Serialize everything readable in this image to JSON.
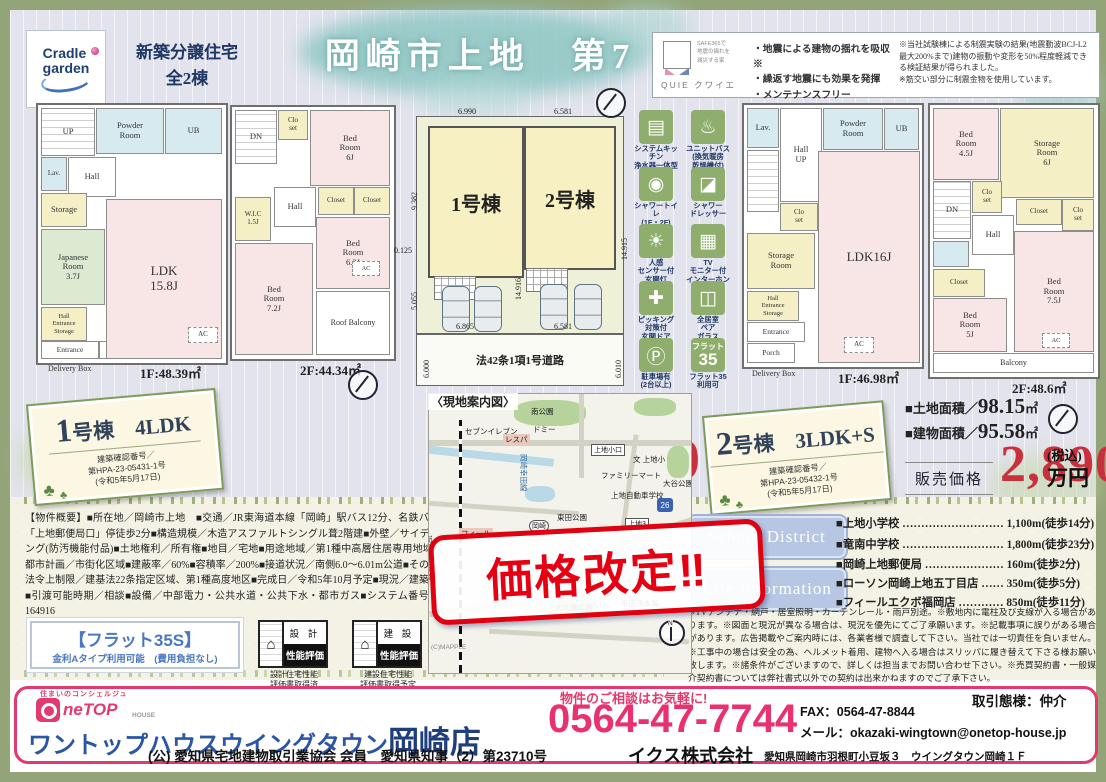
{
  "header": {
    "brand_line1": "Cradle",
    "brand_line2": "garden",
    "subtitle": "新築分譲住宅\n全2棟",
    "title": "岡崎市上地　第7",
    "quie": {
      "safe_text": "SAFE365で\n地震の揺れを\n減災する家",
      "brand": "QUIE クワイエ",
      "features": "・地震による建物の揺れを吸収※\n・繰返す地震にも効果を発揮\n・メンテナンスフリー",
      "note": "※当社試験棟による制震実験の結果(地震動波BCJ-L2最大200%まで)建物の振動や変形を50%程度軽減できる検証結果が得られました。\n※筋交い部分に制震金物を使用しています。"
    }
  },
  "plans": {
    "a1": {
      "rooms": [
        "UP",
        "Powder\nRoom",
        "UB",
        "Lav.",
        "Hall",
        "Storage",
        "Japanese\nRoom\n3.7J",
        "Hall\nEntrance\nStorage",
        "Entrance",
        "Porch",
        "LDK\n15.8J",
        "AC"
      ],
      "delivery": "Delivery Box",
      "area": "1F:48.39㎡"
    },
    "a2": {
      "rooms": [
        "DN",
        "Clo\nset",
        "Bed\nRoom\n6J",
        "W.I.C\n1.5J",
        "Hall",
        "Closet",
        "Closet",
        "Bed\nRoom\n6.3J",
        "Bed\nRoom\n7.2J",
        "Roof Balcony",
        "AC"
      ],
      "area": "2F:44.34㎡"
    },
    "b1": {
      "rooms": [
        "Lav.",
        "Hall\nUP",
        "Powder\nRoom",
        "UB",
        "Clo\nset",
        "Storage\nRoom",
        "Hall\nEntrance\nStorage",
        "Entrance",
        "Porch",
        "LDK16J",
        "AC"
      ],
      "delivery": "Delivery Box",
      "area": "1F:46.98㎡"
    },
    "b2": {
      "rooms": [
        "Bed\nRoom\n4.5J",
        "Storage\nRoom\n6J",
        "DN",
        "Clo\nset",
        "Hall",
        "Closet",
        "Clo\nset",
        "Closet",
        "Bed\nRoom\n5J",
        "Bed\nRoom\n7.5J",
        "Balcony",
        "AC"
      ],
      "area": "2F:48.6㎡"
    }
  },
  "siteplan": {
    "unit1": "1号棟",
    "unit2": "2号棟",
    "road": "法42条1項1号道路",
    "dims": {
      "top1": "6.990",
      "top2": "6.581",
      "left1": "9.382",
      "left2": "0.125",
      "left3": "5.055",
      "mid": "14.916",
      "right1": "14.915",
      "bottom1": "6.865",
      "bottom2": "6.581",
      "road_left": "6.000",
      "road_right": "6.010"
    }
  },
  "features_icons": {
    "items": [
      {
        "glyph": "▤",
        "caption": "システムキッチン\n浄水器一体型\n水栓"
      },
      {
        "glyph": "♨",
        "caption": "ユニットバス\n(換気暖房\n乾燥機付)"
      },
      {
        "glyph": "◉",
        "caption": "シャワートイレ\n(1F・2F)"
      },
      {
        "glyph": "◪",
        "caption": "シャワー\nドレッサー"
      },
      {
        "glyph": "☀",
        "caption": "人感\nセンサー付\n玄関灯"
      },
      {
        "glyph": "▦",
        "caption": "TV\nモニター付\nインターホン"
      },
      {
        "glyph": "✚",
        "caption": "ピッキング\n対策付\n玄関ドア"
      },
      {
        "glyph": "◫",
        "caption": "全居室\nペア\nガラス"
      },
      {
        "glyph": "Ⓟ",
        "caption": "駐車場有\n(2台以上)"
      },
      {
        "glyph_top": "フラット",
        "glyph_big": "35",
        "caption": "フラット35\n利用可"
      }
    ]
  },
  "unit1": {
    "badge_title": "1号棟　4LDK",
    "approval": "建築確認番号／\n第HPA-23-05431-1号\n(令和5年5月17日)",
    "land_label": "■土地面積／",
    "land_value": "103.63",
    "land_unit": "㎡",
    "bldg_label": "■建物面積／",
    "bldg_value": "92.73",
    "bldg_unit": "㎡",
    "balcony_line": "■ルーフバルコニー面積／5.67㎡",
    "price_label": "販売価格",
    "price": "3,150",
    "tax": "(税込)",
    "unit": "万円"
  },
  "unit2": {
    "badge_title": "2号棟　3LDK+S",
    "approval": "建築確認番号／\n第HPA-23-05432-1号\n(令和5年5月17日)",
    "land_label": "■土地面積／",
    "land_value": "98.15",
    "land_unit": "㎡",
    "bldg_label": "■建物面積／",
    "bldg_value": "95.58",
    "bldg_unit": "㎡",
    "price_label": "販売価格",
    "price": "2,890",
    "tax": "(税込)",
    "unit": "万円"
  },
  "map": {
    "title": "〈現地案内図〉",
    "credit": "(C)MAPPLE",
    "labels": {
      "park1": "南公園",
      "conv1": "セブンイレブン",
      "store1": "ドミー",
      "store2": "レスパ",
      "stop1": "上地小口",
      "school1": "文 上地小",
      "park2": "大谷公園",
      "conv2": "ファミリーマート",
      "school2": "上地自動車学校",
      "park3": "東田公園",
      "box1": "上地3",
      "box2": "岡崎",
      "store3": "フィール",
      "park4": "大久後公園",
      "facility": "幸田浄水場",
      "rail": "JR東海道本線",
      "roadname": "岡崎幸田線",
      "route": "26",
      "north": "N"
    }
  },
  "stamp": {
    "text": "価格改定‼"
  },
  "overview": {
    "text": "【物件概要】■所在地／岡崎市上地　■交通／JR東海道本線「岡崎」駅バス12分、名鉄バス「上地郵便局口」停徒歩2分■構造規模／木造アスファルトシングル葺2階建■外壁／サイディング(防汚機能付品)■土地権利／所有権■地目／宅地■用途地域／第1種中高層住居専用地域■都市計画／市街化区域■建蔽率／60%■容積率／200%■接道状況／南側6.0〜6.01m公道■その他法令上制限／建基法22条指定区域、第1種高度地区■完成日／令和5年10月予定■現況／建築中■引渡可能時期／相談■設備／中部電力・公共水道・公共下水・都市ガス■システム番号／164916"
  },
  "flat35": {
    "line1": "【フラット35S】",
    "line2": "金利Aタイプ利用可能　(費用負担なし)"
  },
  "badges": {
    "design": {
      "glyph": "⌂",
      "side": "設 計",
      "main": "性能評価",
      "caption": "設計住宅性能\n評価書取得済"
    },
    "construction": {
      "glyph": "⌂",
      "side": "建 設",
      "main": "性能評価",
      "caption": "建設住宅性能\n評価書取得予定"
    }
  },
  "school": {
    "label": "School District",
    "items": "■上地小学校 ……………………… 1,100m(徒歩14分)\n■竜南中学校 ……………………… 1,800m(徒歩23分)"
  },
  "life": {
    "label": "Life Information",
    "items": "■岡崎上地郵便局 ………………… 160m(徒歩2分)\n■ローソン岡崎上地五丁目店 …… 350m(徒歩5分)\n■フィールエクボ福岡店 ………… 850m(徒歩11分)"
  },
  "disclaimer": {
    "text": "※TVアンテナ・網戸・居室照明・カーテンレール・雨戸別途。※敷地内に電柱及び支線が入る場合があります。※図面と現況が異なる場合は、現況を優先にてご了承願います。※記載事項に誤りがある場合があります。広告掲載やご案内時には、各業者様で調査して下さい。当社では一切責任を負いません。※工事中の場合は安全の為、ヘルメット着用、建物へ入る場合はスリッパに履き替えて下さる様お願い致します。※諸条件がございますので、詳しくは担当までお問い合わせ下さい。※売買契約書・一般媒介契約書については弊社書式以外での契約は出来かねますのでご了承下さい。"
  },
  "footer": {
    "concierge": "住まいのコンシェルジュ",
    "logo_ne": "neTOP",
    "logo_house": "HOUSE",
    "store": "ワントップハウスウイングタウン",
    "branch": "岡崎店",
    "association": "(公) 愛知県宅地建物取引業協会 会員　愛知県知事（2）第23710号",
    "cta": "物件のご相談はお気軽に!",
    "phone": "0564-47-7744",
    "fax_mail": "FAX：0564-47-8844\nメール：okazaki-wingtown@onetop-house.jp",
    "deal_type": "取引態様：仲介",
    "company": "イクス株式会社",
    "address": "愛知県岡崎市羽根町小豆坂３　ウイングタウン岡崎１Ｆ"
  },
  "colors": {
    "accent_pink": "#e23a6d",
    "price_red": "#c9303e",
    "navy": "#1f3864",
    "icon_green": "#8fae6d"
  }
}
